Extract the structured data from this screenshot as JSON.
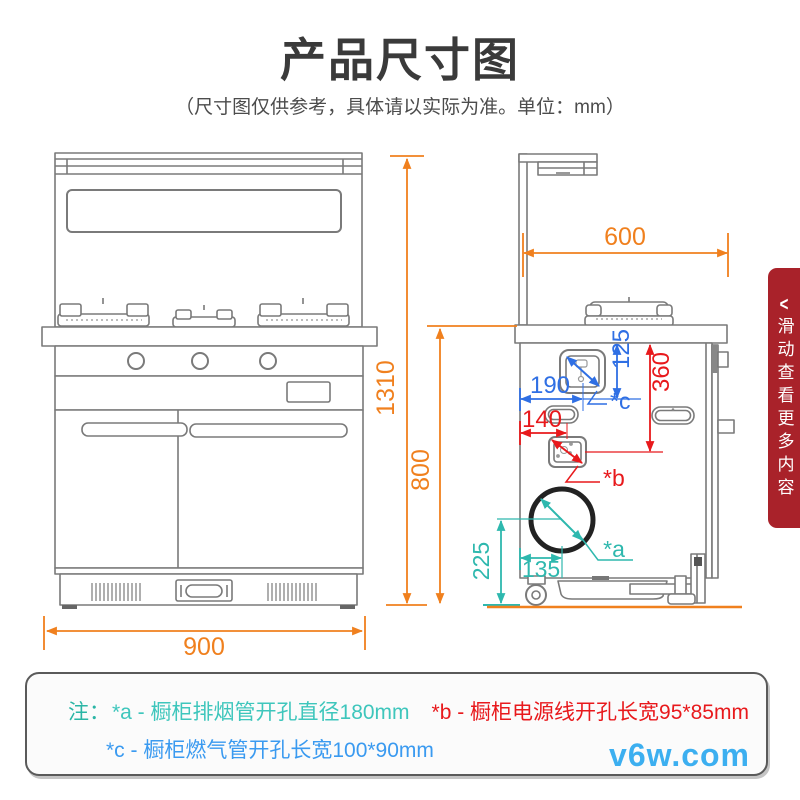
{
  "page": {
    "title": "产品尺寸图",
    "subtitle": "（尺寸图仅供参考，具体请以实际为准。单位：mm）"
  },
  "dimensions": {
    "front_width": "900",
    "total_height": "1310",
    "counter_height": "800",
    "depth": "600",
    "hole_c_from_left": "190",
    "hole_c_from_top": "125",
    "hole_b_from_top": "360",
    "hole_b_from_left": "140",
    "hole_a_from_bottom": "225",
    "hole_a_from_left": "135"
  },
  "hole_labels": {
    "a": "*a",
    "b": "*b",
    "c": "*c"
  },
  "side_banner": {
    "arrow": "<",
    "label": "滑动查看更多内容"
  },
  "notes": {
    "prefix": "注：",
    "note_a": "*a - 橱柜排烟管开孔直径180mm",
    "note_b": "*b - 橱柜电源线开孔长宽95*85mm",
    "note_c": "*c - 橱柜燃气管开孔长宽100*90mm"
  },
  "watermark": "v6w.com",
  "colors": {
    "dimension_orange": "#f0801e",
    "dimension_blue": "#2f6fe4",
    "dimension_red": "#e8191c",
    "dimension_teal": "#2eb8ae",
    "drawing_gray": "#7a7a7a",
    "banner_red": "#a9222a",
    "note_green": "#2ab5a5",
    "note_teal": "#3ec6bc",
    "note_red": "#e8191c",
    "note_blue": "#3a9af0",
    "watermark_blue": "#3caff0"
  }
}
